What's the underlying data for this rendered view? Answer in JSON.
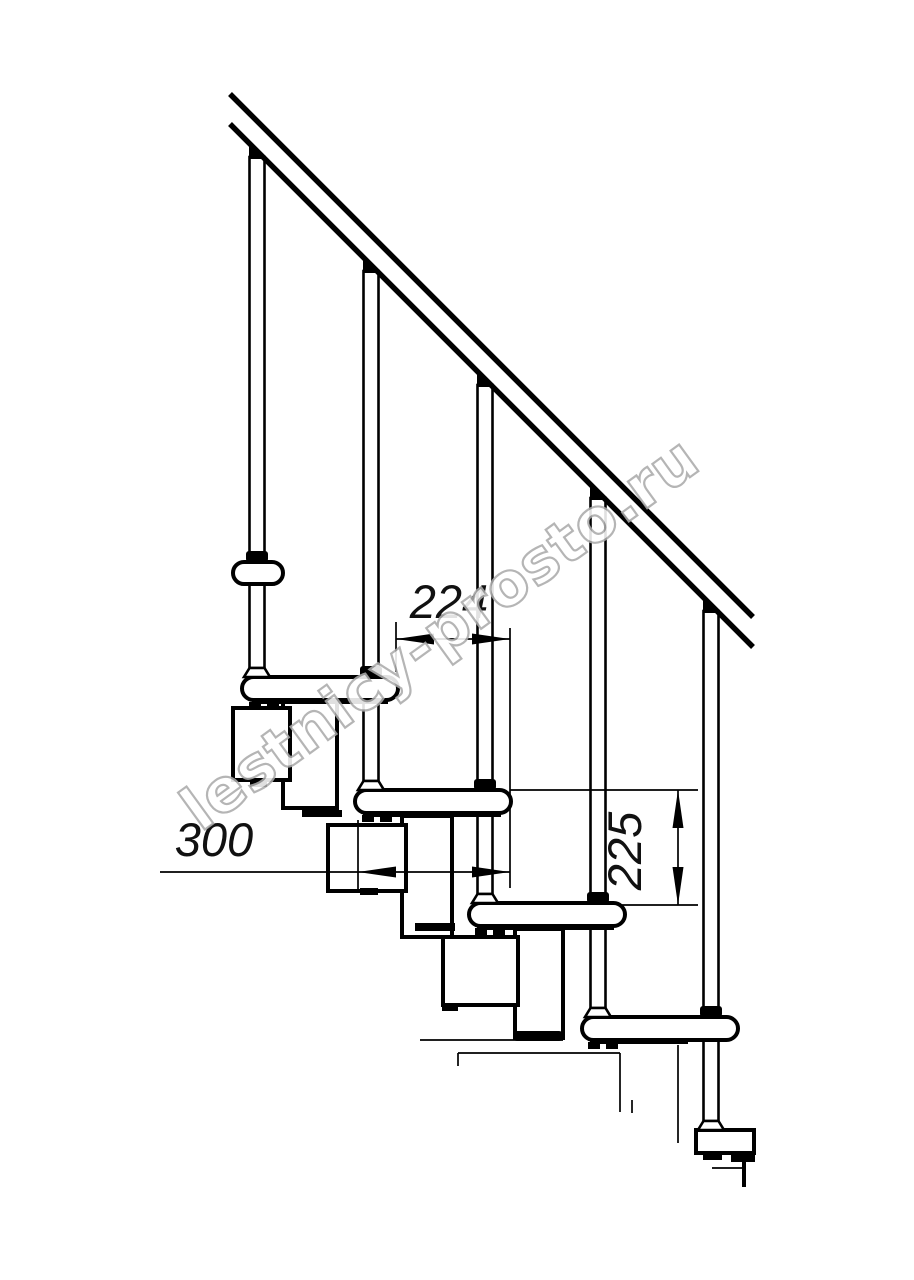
{
  "page": {
    "background": "#ffffff",
    "line_color": "#000000",
    "kind": "staircase side-view technical drawing"
  },
  "dimensions": {
    "run": {
      "value": "224"
    },
    "depth": {
      "value": "300"
    },
    "rise": {
      "value": "225"
    }
  },
  "watermark": {
    "text": "lestnicy-prosto.ru",
    "fill": "#ffffff",
    "outline": "#ababab"
  },
  "components": {
    "handrail": "handrail",
    "baluster_count": 5,
    "tread_count": 5
  }
}
